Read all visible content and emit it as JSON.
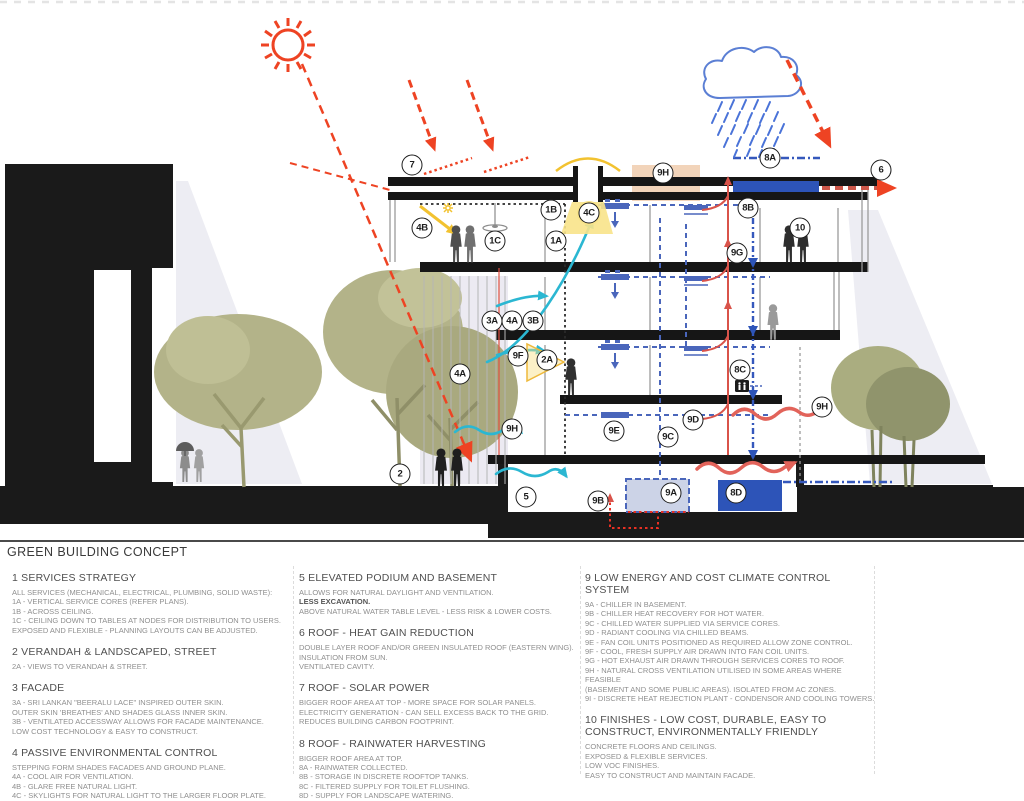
{
  "legend": {
    "title": "GREEN BUILDING CONCEPT",
    "columns": [
      {
        "sections": [
          {
            "heading": "1  SERVICES STRATEGY",
            "lines": [
              "ALL SERVICES (MECHANICAL, ELECTRICAL, PLUMBING, SOLID WASTE):",
              "1A - VERTICAL SERVICE CORES (REFER PLANS).",
              "1B - ACROSS CEILING.",
              "1C - CEILING DOWN TO TABLES AT NODES FOR DISTRIBUTION TO USERS.",
              "EXPOSED AND FLEXIBLE - PLANNING LAYOUTS CAN BE ADJUSTED."
            ]
          },
          {
            "heading": "2  VERANDAH & LANDSCAPED, STREET",
            "lines": [
              "2A - VIEWS TO VERANDAH &  STREET."
            ]
          },
          {
            "heading": "3  FACADE",
            "lines": [
              "3A - SRI LANKAN \"BEERALU LACE\" INSPIRED OUTER SKIN.",
              "OUTER SKIN 'BREATHES' AND SHADES GLASS INNER SKIN.",
              "3B - VENTILATED ACCESSWAY ALLOWS FOR FACADE MAINTENANCE.",
              "LOW COST TECHNOLOGY & EASY TO CONSTRUCT."
            ]
          },
          {
            "heading": "4 PASSIVE ENVIRONMENTAL CONTROL",
            "lines": [
              "STEPPING FORM SHADES FACADES AND GROUND PLANE.",
              "4A - COOL AIR FOR VENTILATION.",
              "4B - GLARE FREE NATURAL LIGHT.",
              "4C - SKYLIGHTS FOR NATURAL LIGHT TO THE LARGER FLOOR PLATE."
            ]
          }
        ]
      },
      {
        "sections": [
          {
            "heading": "5 ELEVATED PODIUM AND BASEMENT",
            "lines": [
              "ALLOWS FOR NATURAL DAYLIGHT AND VENTILATION.",
              "LESS EXCAVATION.",
              "ABOVE NATURAL WATER TABLE LEVEL - LESS RISK & LOWER COSTS."
            ],
            "bold": [
              1
            ]
          },
          {
            "heading": "6  ROOF - HEAT GAIN REDUCTION",
            "lines": [
              "DOUBLE LAYER ROOF AND/OR GREEN INSULATED ROOF (EASTERN WING).",
              "INSULATION FROM SUN.",
              "VENTILATED CAVITY."
            ]
          },
          {
            "heading": "7 ROOF - SOLAR POWER",
            "lines": [
              "BIGGER ROOF AREA AT TOP - MORE SPACE FOR SOLAR PANELS.",
              "ELECTRICITY GENERATION - CAN SELL EXCESS BACK TO THE GRID.",
              "REDUCES BUILDING CARBON FOOTPRINT."
            ]
          },
          {
            "heading": "8 ROOF - RAINWATER HARVESTING",
            "lines": [
              "BIGGER ROOF AREA AT TOP.",
              "8A - RAINWATER COLLECTED.",
              "8B - STORAGE IN DISCRETE ROOFTOP TANKS.",
              "8C - FILTERED SUPPLY FOR TOILET FLUSHING.",
              "8D - SUPPLY FOR LANDSCAPE WATERING."
            ]
          }
        ]
      },
      {
        "sections": [
          {
            "heading": "9  LOW ENERGY AND COST CLIMATE CONTROL SYSTEM",
            "lines": [
              "9A - CHILLER IN BASEMENT.",
              "9B - CHILLER HEAT RECOVERY FOR HOT WATER.",
              "9C - CHILLED WATER SUPPLIED VIA SERVICE CORES.",
              "9D - RADIANT COOLING VIA CHILLED BEAMS.",
              "9E - FAN COIL UNITS POSITIONED AS REQUIRED ALLOW ZONE CONTROL.",
              "9F - COOL, FRESH SUPPLY AIR DRAWN INTO FAN COIL UNITS.",
              "9G - HOT EXHAUST AIR DRAWN THROUGH SERVICES CORES TO ROOF.",
              "9H - NATURAL CROSS VENTILATION UTILISED IN SOME AREAS WHERE FEASIBLE",
              "(BASEMENT AND SOME PUBLIC AREAS). ISOLATED FROM AC ZONES.",
              "9I - DISCRETE HEAT REJECTION PLANT - CONDENSOR AND COOLING TOWERS."
            ]
          },
          {
            "heading": "10 FINISHES - LOW COST, DURABLE, EASY TO CONSTRUCT, ENVIRONMENTALLY FRIENDLY",
            "lines": [
              "CONCRETE FLOORS AND CEILINGS.",
              "EXPOSED & FLEXIBLE SERVICES.",
              "LOW VOC FINISHES.",
              "EASY TO CONSTRUCT AND MAINTAIN FACADE."
            ]
          }
        ]
      }
    ]
  },
  "diagram": {
    "callouts": [
      {
        "label": "7",
        "x": 412,
        "y": 165
      },
      {
        "label": "4B",
        "x": 422,
        "y": 228
      },
      {
        "label": "1C",
        "x": 495,
        "y": 241
      },
      {
        "label": "1B",
        "x": 551,
        "y": 210
      },
      {
        "label": "1A",
        "x": 556,
        "y": 241
      },
      {
        "label": "4C",
        "x": 589,
        "y": 213,
        "glow": true
      },
      {
        "label": "9H",
        "x": 663,
        "y": 173
      },
      {
        "label": "8A",
        "x": 770,
        "y": 158
      },
      {
        "label": "6",
        "x": 881,
        "y": 170
      },
      {
        "label": "8B",
        "x": 748,
        "y": 208
      },
      {
        "label": "10",
        "x": 800,
        "y": 228
      },
      {
        "label": "9G",
        "x": 737,
        "y": 253
      },
      {
        "label": "3A",
        "x": 492,
        "y": 321
      },
      {
        "label": "4A",
        "x": 512,
        "y": 321
      },
      {
        "label": "3B",
        "x": 533,
        "y": 321
      },
      {
        "label": "9F",
        "x": 518,
        "y": 356
      },
      {
        "label": "2A",
        "x": 547,
        "y": 360,
        "glow": true
      },
      {
        "label": "4A",
        "x": 460,
        "y": 374
      },
      {
        "label": "9H",
        "x": 512,
        "y": 429
      },
      {
        "label": "9E",
        "x": 614,
        "y": 431
      },
      {
        "label": "9C",
        "x": 668,
        "y": 437
      },
      {
        "label": "9D",
        "x": 693,
        "y": 420
      },
      {
        "label": "8C",
        "x": 740,
        "y": 370
      },
      {
        "label": "9H",
        "x": 822,
        "y": 407
      },
      {
        "label": "2",
        "x": 400,
        "y": 474
      },
      {
        "label": "5",
        "x": 526,
        "y": 497
      },
      {
        "label": "9B",
        "x": 598,
        "y": 501
      },
      {
        "label": "9A",
        "x": 671,
        "y": 493
      },
      {
        "label": "8D",
        "x": 736,
        "y": 493
      }
    ],
    "icons": [
      "sun-icon",
      "rain-cloud-icon",
      "ceiling-fan-icon",
      "toilet-icon",
      "skylight-glow",
      "solar-panel-arrows",
      "tree-icon",
      "person-icon",
      "umbrella-icon"
    ],
    "colors": {
      "accent_red": "#ee4323",
      "flow_red": "#d9534a",
      "wavy_red": "#e2635a",
      "cool_cyan": "#2bb7d2",
      "water_blue": "#3558bc",
      "chilled_blue": "#4a66bb",
      "daylight_yellow": "#f2c230",
      "roof_vent_tan": "#f2d4ba",
      "tree_olive": "#b3b389",
      "shadow_gray": "#ededf3",
      "ink": "#1a1a1a"
    }
  }
}
